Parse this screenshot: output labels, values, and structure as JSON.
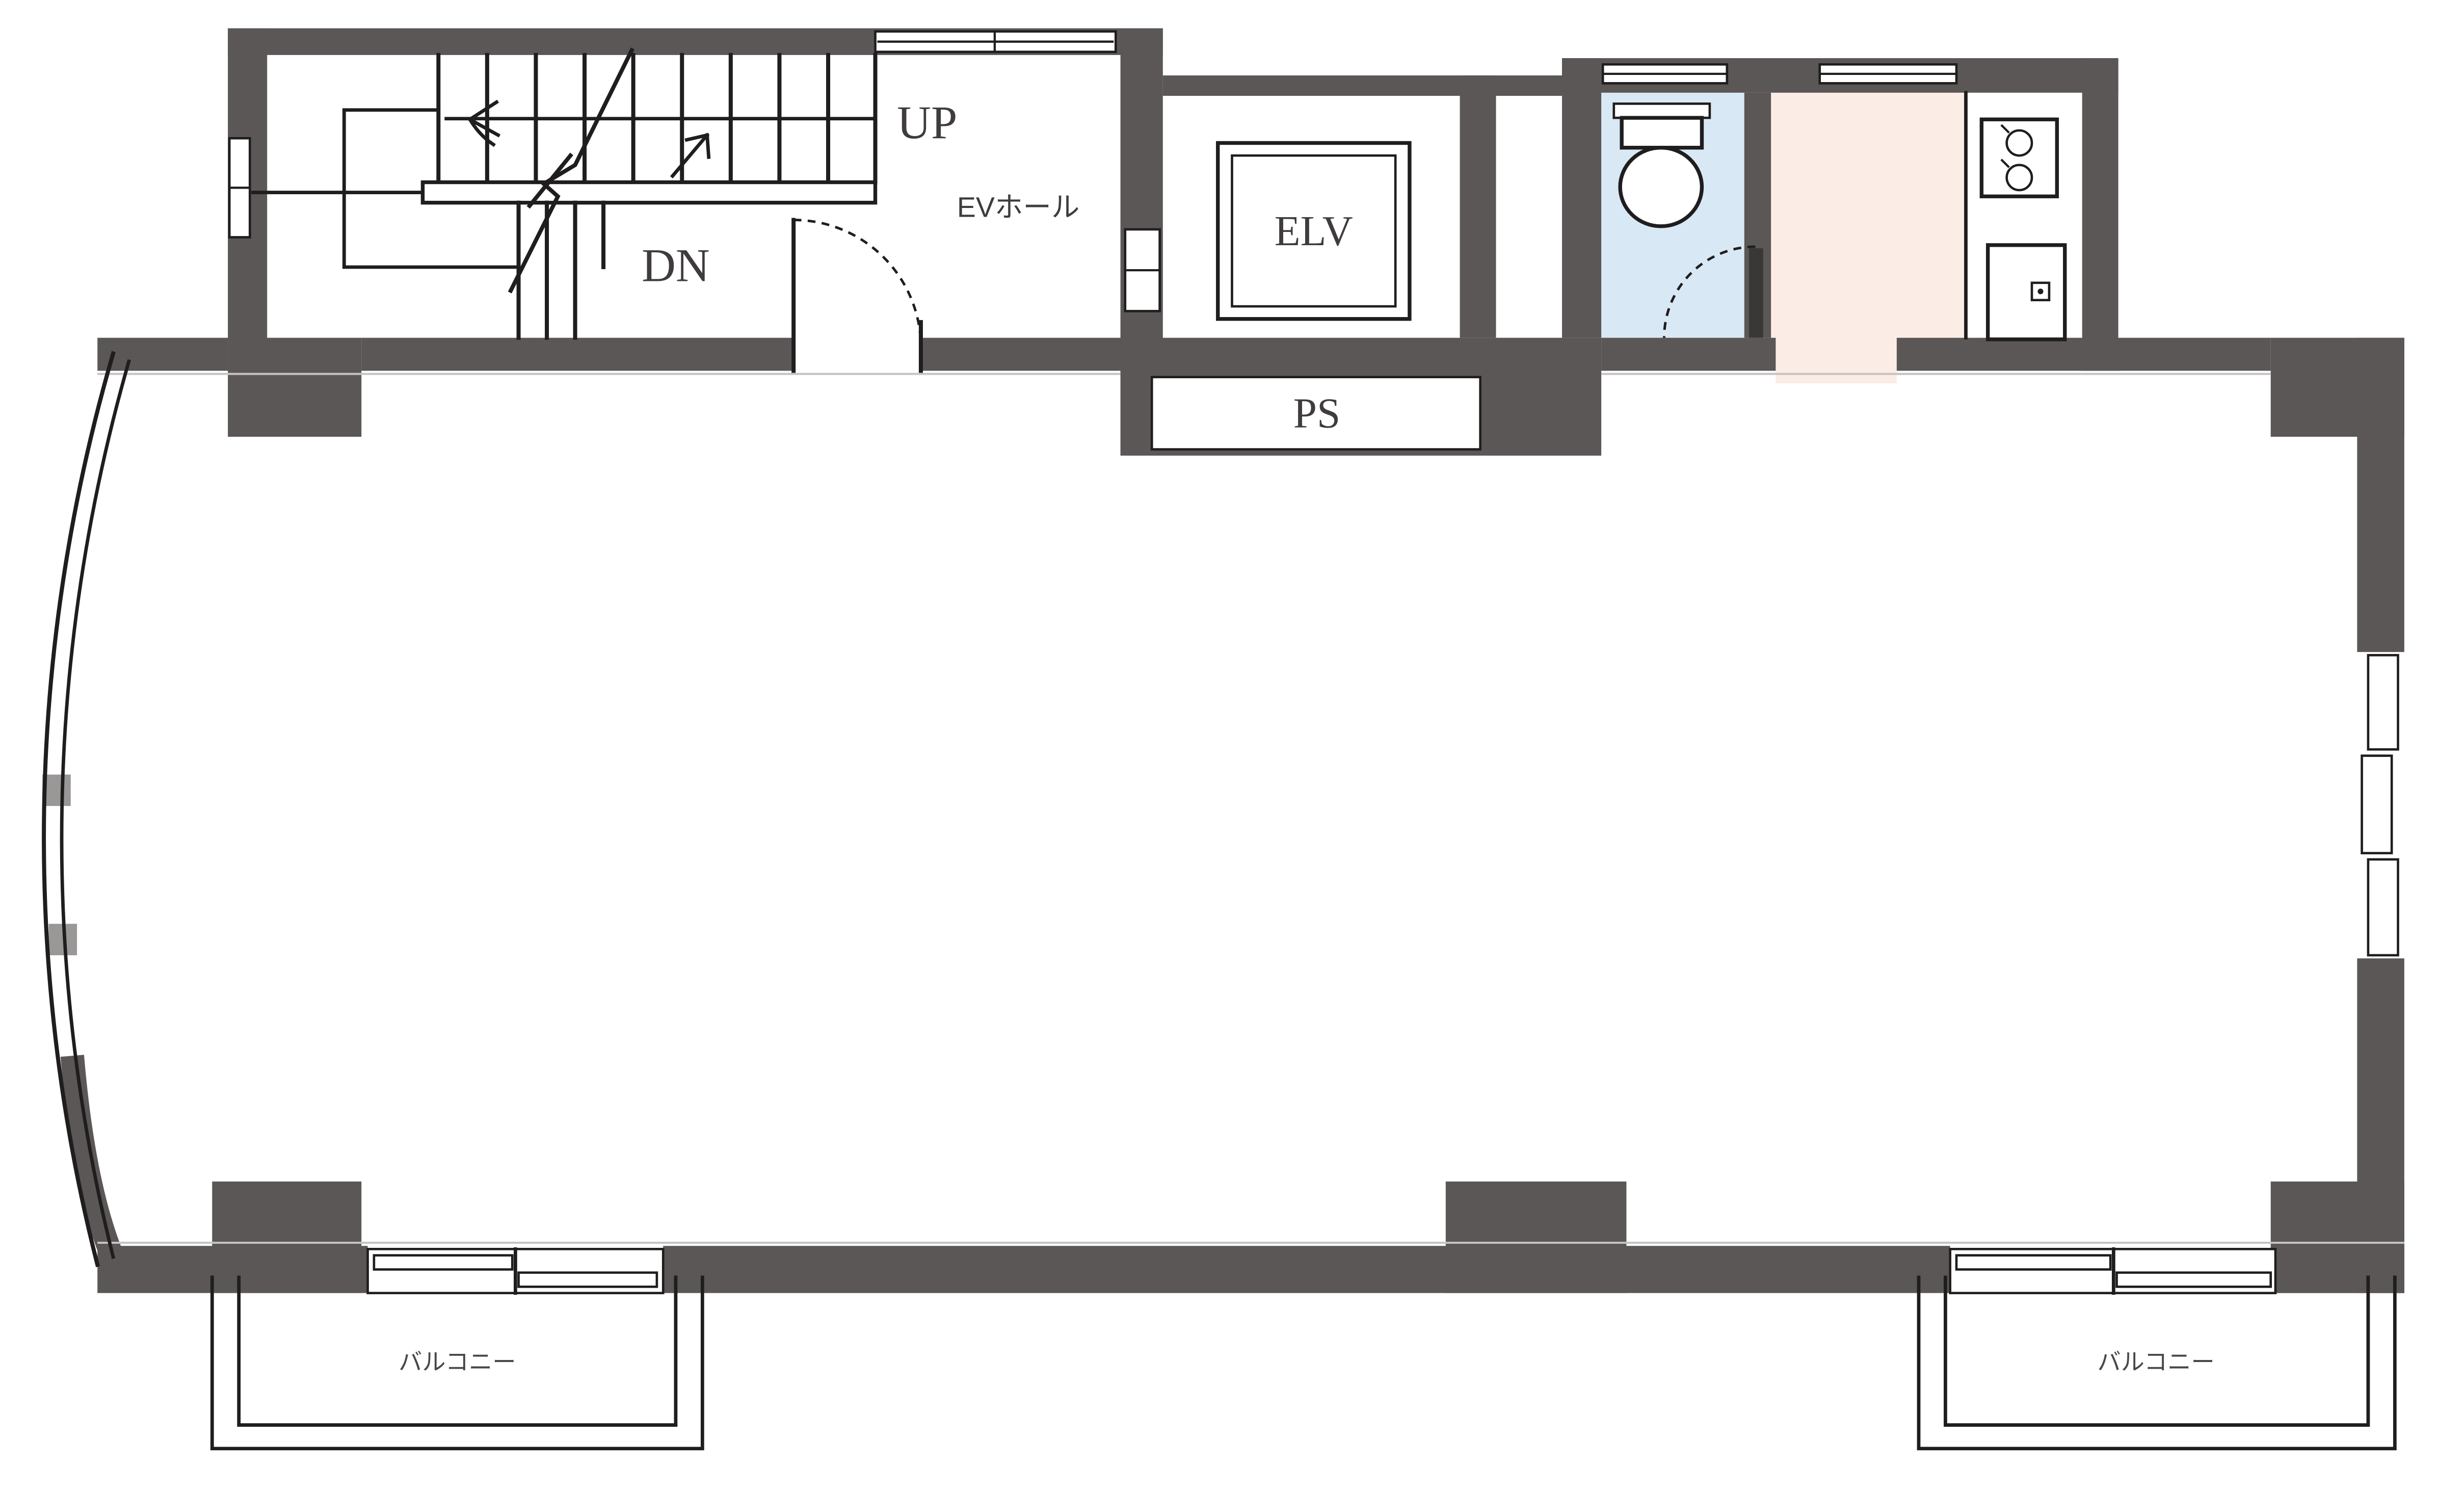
{
  "labels": {
    "up": "UP",
    "down": "DN",
    "elevator_hall": "EVホール",
    "elevator": "ELV",
    "pipe_space": "PS",
    "balcony_left": "バルコニー",
    "balcony_right": "バルコニー"
  },
  "colors": {
    "wall": "#5b5757",
    "line": "#1f1d1d",
    "toilet_room": "#d9e8f5",
    "kitchen_room": "#fbece5",
    "label_text": "#403c3c",
    "background": "#ffffff"
  }
}
